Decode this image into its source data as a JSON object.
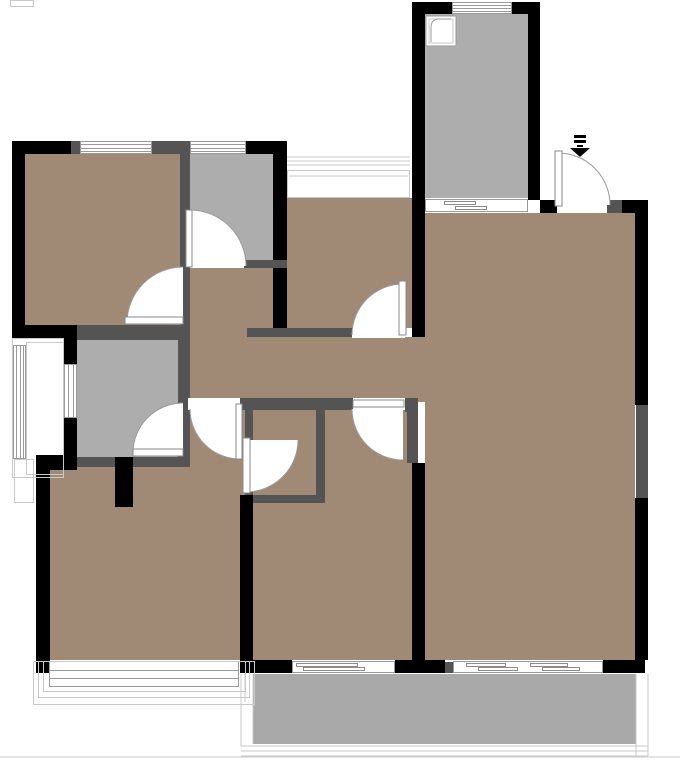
{
  "canvas": {
    "w": 680,
    "h": 763
  },
  "colors": {
    "floor": "#a08a75",
    "room_gray": "#adadad",
    "balcony_gray": "#a9a9a9",
    "wall_black": "#000000",
    "wall_gray": "#545454",
    "opening_white": "#ffffff",
    "line": "#9a9a9a",
    "line_light": "#c9c9c9",
    "leaf_border": "#8a8a8a"
  },
  "rooms": [
    {
      "name": "bedroom-top-left",
      "fill": "floor",
      "x": 25,
      "y": 154,
      "w": 155,
      "h": 171
    },
    {
      "name": "study-room",
      "fill": "floor",
      "x": 287,
      "y": 198,
      "w": 125,
      "h": 130
    },
    {
      "name": "living-room",
      "fill": "floor",
      "x": 425,
      "y": 213,
      "w": 210,
      "h": 447
    },
    {
      "name": "passage-gap",
      "fill": "floor",
      "x": 412,
      "y": 337,
      "w": 13,
      "h": 65
    },
    {
      "name": "hall-alcove",
      "fill": "floor",
      "x": 188,
      "y": 268,
      "w": 85,
      "h": 69
    },
    {
      "name": "hallway",
      "fill": "floor",
      "x": 188,
      "y": 337,
      "w": 224,
      "h": 61
    },
    {
      "name": "hallway-south",
      "fill": "floor",
      "x": 188,
      "y": 398,
      "w": 57,
      "h": 109
    },
    {
      "name": "bedroom-bottom-middle",
      "fill": "floor",
      "x": 253,
      "y": 398,
      "w": 159,
      "h": 262
    },
    {
      "name": "bedroom-bottom-left",
      "fill": "floor",
      "x": 50,
      "y": 467,
      "w": 190,
      "h": 193
    },
    {
      "name": "kitchen",
      "fill": "room_gray",
      "x": 425,
      "y": 14,
      "w": 103,
      "h": 184
    },
    {
      "name": "storage-room",
      "fill": "room_gray",
      "x": 190,
      "y": 154,
      "w": 83,
      "h": 106
    },
    {
      "name": "bathroom",
      "fill": "room_gray",
      "x": 77,
      "y": 340,
      "w": 101,
      "h": 117
    },
    {
      "name": "balcony-bottom",
      "fill": "balcony_gray",
      "x": 253,
      "y": 674,
      "w": 383,
      "h": 70
    }
  ],
  "walls": [
    {
      "x": 12,
      "y": 141,
      "w": 13,
      "h": 197,
      "fill": "wall_black"
    },
    {
      "x": 12,
      "y": 141,
      "w": 59,
      "h": 13,
      "fill": "wall_black"
    },
    {
      "x": 71,
      "y": 141,
      "w": 9,
      "h": 13,
      "fill": "wall_gray"
    },
    {
      "x": 152,
      "y": 141,
      "w": 38,
      "h": 13,
      "fill": "wall_gray"
    },
    {
      "x": 246,
      "y": 141,
      "w": 41,
      "h": 13,
      "fill": "wall_black"
    },
    {
      "x": 273,
      "y": 141,
      "w": 14,
      "h": 196,
      "fill": "wall_black"
    },
    {
      "x": 180,
      "y": 154,
      "w": 10,
      "h": 112,
      "fill": "wall_gray"
    },
    {
      "x": 180,
      "y": 266,
      "w": 10,
      "h": 64,
      "fill": "wall_gray"
    },
    {
      "x": 244,
      "y": 260,
      "w": 43,
      "h": 8,
      "fill": "wall_gray"
    },
    {
      "x": 12,
      "y": 325,
      "w": 65,
      "h": 13,
      "fill": "wall_black"
    },
    {
      "x": 77,
      "y": 325,
      "w": 113,
      "h": 13,
      "fill": "wall_gray"
    },
    {
      "x": 178,
      "y": 330,
      "w": 12,
      "h": 137,
      "fill": "wall_gray"
    },
    {
      "x": 77,
      "y": 330,
      "w": 101,
      "h": 10,
      "fill": "wall_gray"
    },
    {
      "x": 64,
      "y": 338,
      "w": 13,
      "h": 26,
      "fill": "wall_black"
    },
    {
      "x": 64,
      "y": 418,
      "w": 13,
      "h": 52,
      "fill": "wall_black"
    },
    {
      "x": 36,
      "y": 455,
      "w": 41,
      "h": 15,
      "fill": "wall_black"
    },
    {
      "x": 77,
      "y": 457,
      "w": 113,
      "h": 10,
      "fill": "wall_gray"
    },
    {
      "x": 36,
      "y": 470,
      "w": 14,
      "h": 203,
      "fill": "wall_black"
    },
    {
      "x": 115,
      "y": 457,
      "w": 18,
      "h": 50,
      "fill": "wall_black"
    },
    {
      "x": 247,
      "y": 328,
      "w": 105,
      "h": 9,
      "fill": "wall_gray"
    },
    {
      "x": 240,
      "y": 398,
      "w": 113,
      "h": 12,
      "fill": "wall_gray"
    },
    {
      "x": 405,
      "y": 398,
      "w": 13,
      "h": 14,
      "fill": "wall_gray"
    },
    {
      "x": 407,
      "y": 402,
      "w": 11,
      "h": 61,
      "fill": "wall_gray"
    },
    {
      "x": 316,
      "y": 398,
      "w": 9,
      "h": 105,
      "fill": "wall_gray"
    },
    {
      "x": 245,
      "y": 410,
      "w": 8,
      "h": 30,
      "fill": "wall_gray"
    },
    {
      "x": 245,
      "y": 492,
      "w": 8,
      "h": 11,
      "fill": "wall_gray"
    },
    {
      "x": 245,
      "y": 495,
      "w": 80,
      "h": 8,
      "fill": "wall_gray"
    },
    {
      "x": 240,
      "y": 495,
      "w": 13,
      "h": 178,
      "fill": "wall_black"
    },
    {
      "x": 412,
      "y": 2,
      "w": 13,
      "h": 335,
      "fill": "wall_black"
    },
    {
      "x": 412,
      "y": 2,
      "w": 40,
      "h": 12,
      "fill": "wall_black"
    },
    {
      "x": 512,
      "y": 2,
      "w": 28,
      "h": 12,
      "fill": "wall_black"
    },
    {
      "x": 528,
      "y": 2,
      "w": 12,
      "h": 198,
      "fill": "wall_black"
    },
    {
      "x": 540,
      "y": 200,
      "w": 17,
      "h": 13,
      "fill": "wall_black"
    },
    {
      "x": 607,
      "y": 200,
      "w": 15,
      "h": 13,
      "fill": "wall_gray"
    },
    {
      "x": 622,
      "y": 200,
      "w": 26,
      "h": 13,
      "fill": "wall_black"
    },
    {
      "x": 635,
      "y": 213,
      "w": 13,
      "h": 192,
      "fill": "wall_black"
    },
    {
      "x": 636,
      "y": 405,
      "w": 12,
      "h": 93,
      "fill": "wall_gray"
    },
    {
      "x": 635,
      "y": 498,
      "w": 13,
      "h": 162,
      "fill": "wall_black"
    },
    {
      "x": 603,
      "y": 660,
      "w": 42,
      "h": 13,
      "fill": "wall_black"
    },
    {
      "x": 412,
      "y": 463,
      "w": 13,
      "h": 197,
      "fill": "wall_black"
    },
    {
      "x": 240,
      "y": 660,
      "w": 52,
      "h": 13,
      "fill": "wall_black"
    },
    {
      "x": 395,
      "y": 660,
      "w": 50,
      "h": 13,
      "fill": "wall_black"
    },
    {
      "x": 445,
      "y": 662,
      "w": 8,
      "h": 11,
      "fill": "wall_gray"
    }
  ],
  "openings": [
    {
      "x": 188,
      "y": 398,
      "w": 52,
      "h": 12
    },
    {
      "x": 353,
      "y": 398,
      "w": 52,
      "h": 12
    },
    {
      "x": 352,
      "y": 328,
      "w": 53,
      "h": 10
    },
    {
      "x": 557,
      "y": 200,
      "w": 50,
      "h": 13
    }
  ],
  "windows": [
    {
      "name": "window-top-1",
      "x": 80,
      "y": 141,
      "w": 72,
      "h": 13,
      "orient": "h",
      "lines": 3
    },
    {
      "name": "window-top-2",
      "x": 190,
      "y": 141,
      "w": 56,
      "h": 13,
      "orient": "h",
      "lines": 3
    },
    {
      "name": "window-kitchen",
      "x": 452,
      "y": 2,
      "w": 60,
      "h": 12,
      "orient": "h",
      "lines": 3
    },
    {
      "name": "window-balcony-left",
      "x": 13,
      "y": 345,
      "w": 13,
      "h": 114,
      "orient": "v",
      "lines": 3
    },
    {
      "name": "window-bathroom",
      "x": 64,
      "y": 364,
      "w": 13,
      "h": 54,
      "orient": "v",
      "lines": 2
    },
    {
      "name": "window-bedroom-bl",
      "x": 49,
      "y": 661,
      "w": 190,
      "h": 26,
      "orient": "h",
      "lines": 2
    }
  ],
  "sliders": [
    {
      "name": "sliding-door-kitchen",
      "x": 425,
      "y": 199,
      "w": 103,
      "h": 13,
      "marks": [
        [
          444,
          201,
          32
        ],
        [
          455,
          206,
          32
        ]
      ]
    },
    {
      "name": "sliding-window-left",
      "x": 292,
      "y": 661,
      "w": 103,
      "h": 12,
      "marks": [
        [
          296,
          663,
          62
        ],
        [
          303,
          667,
          62
        ]
      ]
    },
    {
      "name": "sliding-window-right",
      "x": 453,
      "y": 661,
      "w": 150,
      "h": 12,
      "marks": [
        [
          466,
          663,
          40
        ],
        [
          478,
          667,
          40
        ],
        [
          530,
          663,
          38
        ],
        [
          542,
          667,
          38
        ]
      ]
    }
  ],
  "outline_rects": [
    {
      "x": 12,
      "y": 338,
      "w": 52,
      "h": 140
    },
    {
      "x": 26,
      "y": 342,
      "w": 38,
      "h": 133
    },
    {
      "x": 14,
      "y": 459,
      "w": 20,
      "h": 44
    },
    {
      "x": 43,
      "y": 661,
      "w": 203,
      "h": 31
    },
    {
      "x": 38,
      "y": 661,
      "w": 212,
      "h": 37
    },
    {
      "x": 33,
      "y": 661,
      "w": 222,
      "h": 44
    },
    {
      "x": 287,
      "y": 170,
      "w": 123,
      "h": 28
    },
    {
      "x": 10,
      "y": 0,
      "w": 24,
      "h": 7
    }
  ],
  "lines": [
    {
      "x1": 287,
      "y1": 157,
      "x2": 410,
      "y2": 157
    },
    {
      "x1": 287,
      "y1": 161,
      "x2": 410,
      "y2": 161
    },
    {
      "x1": 287,
      "y1": 165,
      "x2": 410,
      "y2": 165
    },
    {
      "x1": 289,
      "y1": 176,
      "x2": 408,
      "y2": 176
    },
    {
      "x1": 241,
      "y1": 746,
      "x2": 648,
      "y2": 746
    },
    {
      "x1": 241,
      "y1": 751,
      "x2": 648,
      "y2": 751
    },
    {
      "x1": 241,
      "y1": 756,
      "x2": 648,
      "y2": 756
    },
    {
      "x1": 636,
      "y1": 674,
      "x2": 636,
      "y2": 756
    },
    {
      "x1": 648,
      "y1": 674,
      "x2": 648,
      "y2": 756
    },
    {
      "x1": 253,
      "y1": 674,
      "x2": 253,
      "y2": 744
    },
    {
      "x1": 241,
      "y1": 674,
      "x2": 241,
      "y2": 746
    },
    {
      "x1": 245,
      "y1": 674,
      "x2": 245,
      "y2": 702
    },
    {
      "x1": 0,
      "y1": 757,
      "x2": 680,
      "y2": 757
    }
  ],
  "doors": [
    {
      "name": "door-storage",
      "hinge": [
        190,
        266
      ],
      "r": 56,
      "a0": 270,
      "a1": 360,
      "leaf": [
        186,
        210,
        6,
        57
      ]
    },
    {
      "name": "door-bedroom-tl",
      "hinge": [
        183,
        323
      ],
      "r": 56,
      "a0": 180,
      "a1": 270,
      "leaf": [
        125,
        317,
        58,
        7
      ]
    },
    {
      "name": "door-bathroom",
      "hinge": [
        183,
        453
      ],
      "r": 50,
      "a0": 180,
      "a1": 270,
      "leaf": [
        133,
        449,
        50,
        7
      ]
    },
    {
      "name": "door-hallway-south",
      "hinge": [
        240,
        409
      ],
      "r": 50,
      "a0": 90,
      "a1": 180,
      "leaf": [
        236,
        404,
        6,
        55
      ]
    },
    {
      "name": "door-storage-small",
      "hinge": [
        246,
        440
      ],
      "r": 52,
      "a0": 0,
      "a1": 90,
      "leaf": [
        243,
        438,
        7,
        55
      ]
    },
    {
      "name": "door-study",
      "hinge": [
        403,
        335
      ],
      "r": 51,
      "a0": 180,
      "a1": 270,
      "leaf": [
        399,
        281,
        7,
        54
      ]
    },
    {
      "name": "door-bedroom-mid",
      "hinge": [
        403,
        409
      ],
      "r": 51,
      "a0": 90,
      "a1": 180,
      "leaf": [
        353,
        400,
        51,
        7
      ]
    },
    {
      "name": "door-entrance",
      "hinge": [
        558,
        205
      ],
      "r": 52,
      "a0": 270,
      "a1": 360,
      "leaf": [
        555,
        151,
        7,
        55
      ]
    }
  ],
  "icons": {
    "entry_arrow": {
      "bars": [
        [
          574,
          135,
          12,
          3
        ],
        [
          574,
          140,
          12,
          3
        ],
        [
          577,
          145,
          6,
          2
        ]
      ],
      "head": [
        [
          570,
          148
        ],
        [
          590,
          148
        ],
        [
          580,
          157
        ]
      ]
    },
    "sink": {
      "box": [
        426,
        16,
        30,
        30
      ],
      "curve": "M431,42 L431,27 Q431,20 438,19 L451,19"
    }
  }
}
